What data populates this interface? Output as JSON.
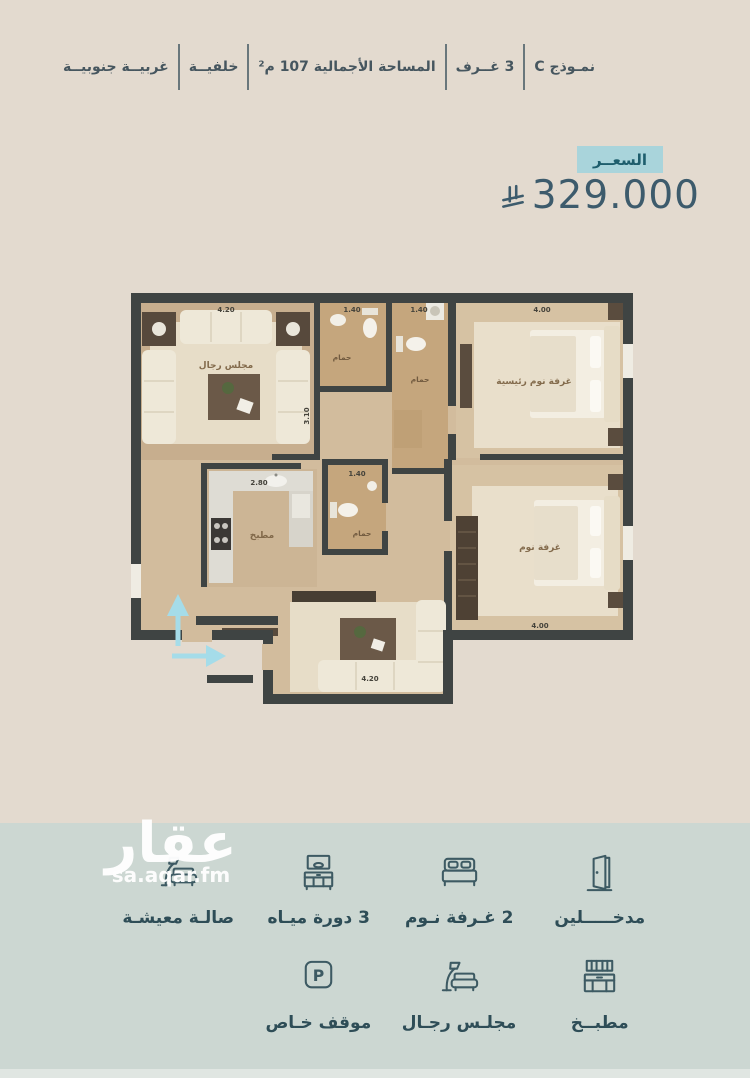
{
  "header": {
    "items": [
      {
        "label": "نمـوذج C"
      },
      {
        "label": "3 غــرف"
      },
      {
        "label": "المساحة الأجمالية 107 م²"
      },
      {
        "label": "خلفيــة"
      },
      {
        "label": "غربيــة جنوبيــة"
      }
    ]
  },
  "price": {
    "badge_label": "السعــر",
    "amount": "329.000",
    "currency_icon": "saudi-riyal-symbol",
    "badge_color": "#a9d4db",
    "text_color": "#3d5b6c"
  },
  "plan": {
    "rooms": {
      "majlis": {
        "label": "مجلس رجال",
        "dim_top": "4.20",
        "dim_side": "3.10"
      },
      "bath1": {
        "label": "حمام",
        "dim": "1.40"
      },
      "bath2": {
        "label": "حمام",
        "dim": "1.40"
      },
      "master": {
        "label": "غرفة نوم رئيسية",
        "dim": "4.00"
      },
      "kitchen": {
        "label": "مطبخ",
        "dim": "2.80"
      },
      "bath3": {
        "label": "حمام",
        "dim": "1.40"
      },
      "bedroom2": {
        "label": "غرفة نوم",
        "dim": "4.00"
      },
      "living": {
        "dim": "4.20"
      }
    },
    "wall_color": "#3f4443",
    "entrance_arrow_color": "#a5dce9"
  },
  "features": {
    "row1": [
      {
        "icon": "door-icon",
        "label": "مدخـــــلين"
      },
      {
        "icon": "bed-icon",
        "label": "2 غـرفة نـوم"
      },
      {
        "icon": "washbasin-icon",
        "label": "3 دورة ميـاه"
      },
      {
        "icon": "sofa-lamp-icon",
        "label": "صالـة معيشـة"
      }
    ],
    "row2": [
      {
        "icon": "kitchen-cabinet-icon",
        "label": "مطبــخ"
      },
      {
        "icon": "sofa-lamp-icon",
        "label": "مجلـس رجـال"
      },
      {
        "icon": "parking-icon",
        "label": "موقف خـاص",
        "letter": "P"
      }
    ]
  },
  "watermark": {
    "logo": "عقار",
    "site": "sa.aqar.fm"
  }
}
